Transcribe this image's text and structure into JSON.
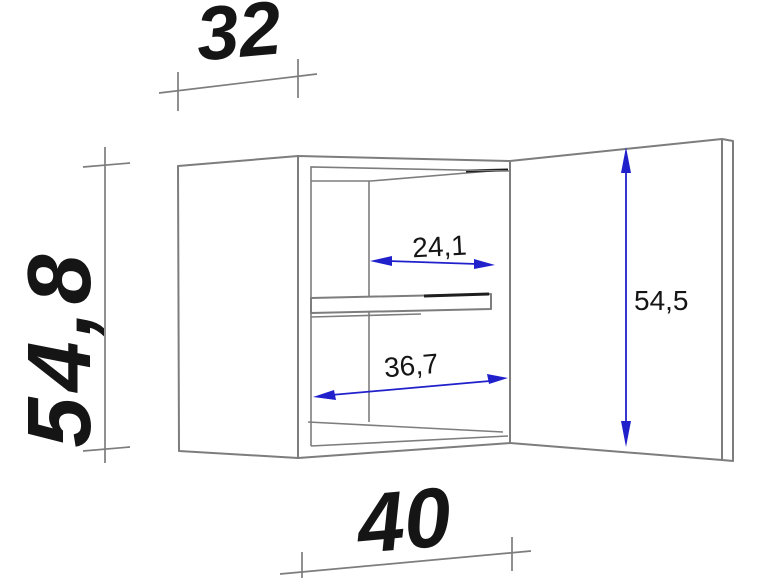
{
  "colors": {
    "background": "#ffffff",
    "line_gray": "#7d7d7d",
    "line_dark": "#1e1e1e",
    "dimension_blue": "#2121cc",
    "text_dark": "#151515"
  },
  "diagram": {
    "kind": "furniture-dimension-drawing",
    "subject": "wall-cabinet-with-open-door-and-shelf",
    "overall_dimensions": {
      "depth": "32",
      "height": "54,8",
      "width": "40"
    },
    "interior_dimensions": {
      "upper_inner_width": "24,1",
      "lower_inner_width": "36,7",
      "door_height": "54,5"
    }
  }
}
